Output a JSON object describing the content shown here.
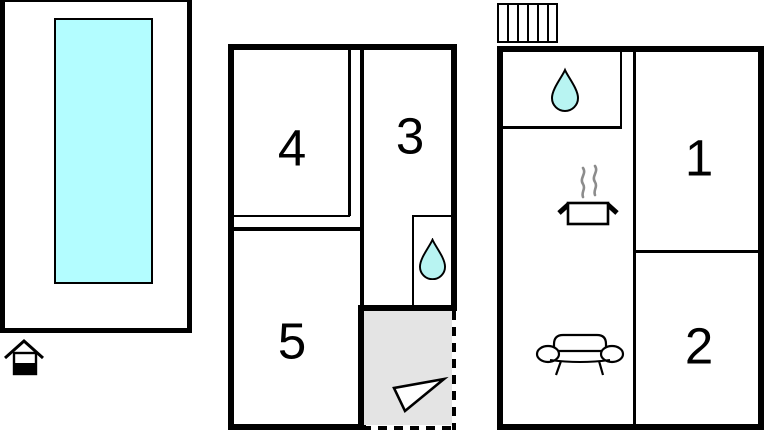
{
  "figure": {
    "type": "floor-plan",
    "description": "Holiday home floor plans with pool"
  },
  "rooms": {
    "middle_plan": {
      "top_left": "4",
      "top_right": "3",
      "bottom_left": "5"
    },
    "right_plan": {
      "top_right": "1",
      "bottom_right": "2"
    }
  },
  "icons": {
    "pool_marker": "house",
    "middle_bathroom": "water-drop",
    "middle_entrance": "direction-arrow",
    "right_bathroom": "water-drop",
    "kitchen": "cooking-pot-with-steam",
    "living_room": "sofa",
    "stairs": "staircase"
  },
  "colors": {
    "pool_water": "#b3fdff",
    "water_drop_fill": "#b8f4f2",
    "entrance_floor": "#e4e4e4",
    "wall": "#000000",
    "steam": "#8c8c8c"
  }
}
